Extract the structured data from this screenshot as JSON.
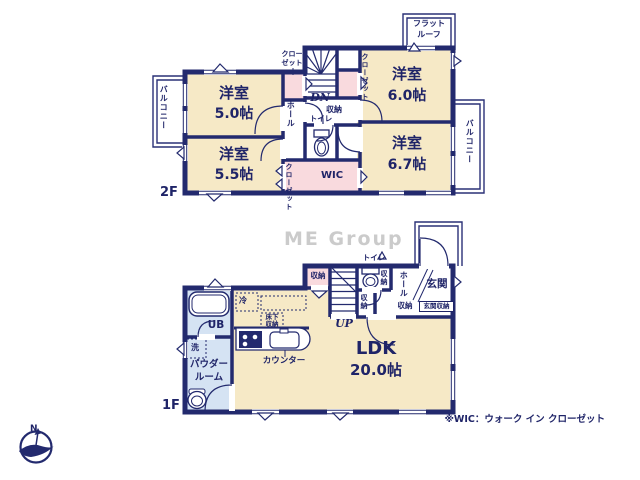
{
  "watermark": "ME Group",
  "note": "※WIC：ウォーク イン クローゼット",
  "compass": {
    "north": "N"
  },
  "colors": {
    "wall": "#232a6e",
    "room": "#f6e9c6",
    "closet": "#f9dade",
    "bath": "#d5e3f3",
    "text": "#1f2468"
  },
  "floor2": {
    "label": "2F",
    "room_nw_name": "洋室",
    "room_nw_size": "5.0帖",
    "room_ne_name": "洋室",
    "room_ne_size": "6.0帖",
    "room_sw_name": "洋室",
    "room_sw_size": "5.5帖",
    "room_se_name": "洋室",
    "room_se_size": "6.7帖",
    "closet_nw_l1": "クロー",
    "closet_nw_l2": "ゼット",
    "closet_ne": "クローゼット",
    "closet_sw": "クローゼット",
    "wic": "WIC",
    "hall": "ホール",
    "storage": "収納",
    "toilet": "トイレ",
    "stairs_down": "DN",
    "balcony_left": "バルコニー",
    "balcony_right": "バルコニー",
    "flat_roof_l1": "フラット",
    "flat_roof_l2": "ルーフ"
  },
  "floor1": {
    "label": "1F",
    "ldk_name": "LDK",
    "ldk_size": "20.0帖",
    "ub": "UB",
    "wash": "洗",
    "powder_l1": "パウダー",
    "powder_l2": "ルーム",
    "fridge": "冷",
    "underfloor_l1": "床下",
    "underfloor_l2": "収納",
    "counter": "カウンター",
    "stairs_up": "UP",
    "storage_pink": "収納",
    "storage_toilet": "収納",
    "storage_hall_v": "収納",
    "storage_hall_h": "収納",
    "toilet": "トイレ",
    "hall": "ホール",
    "entrance": "玄関",
    "entrance_storage": "玄関収納"
  }
}
